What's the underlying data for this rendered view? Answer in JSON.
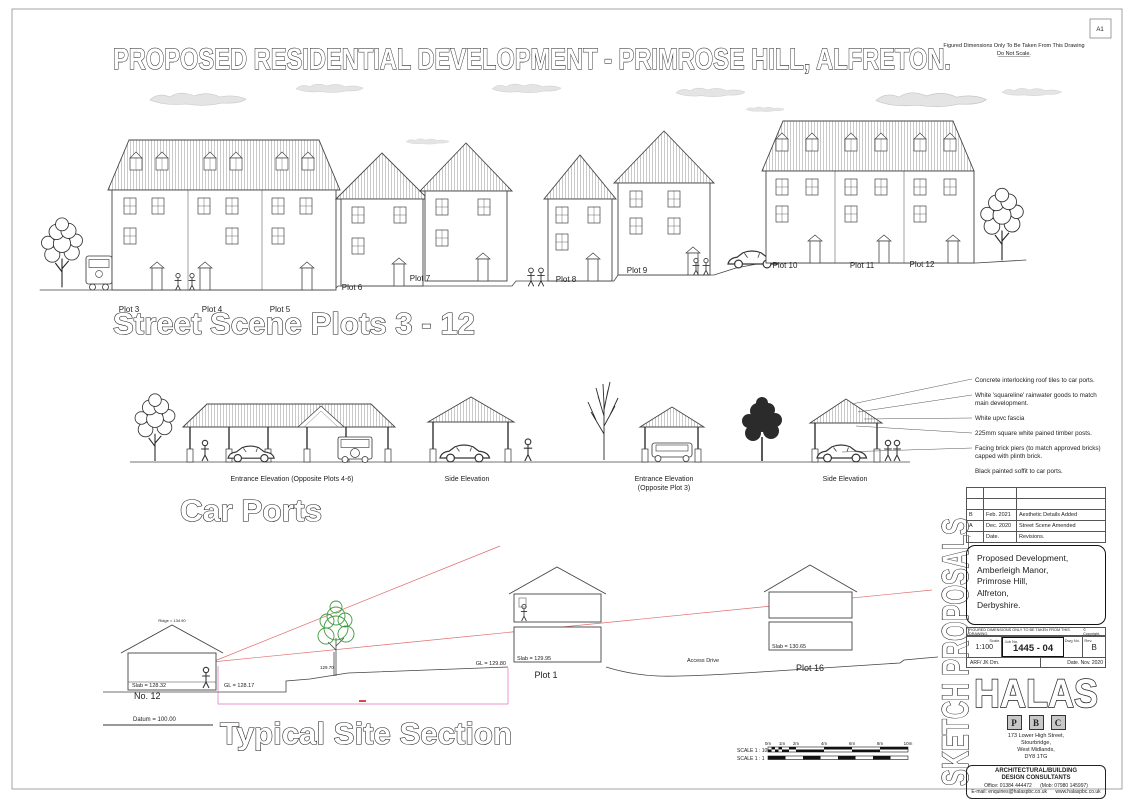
{
  "sheet": {
    "title": "PROPOSED RESIDENTIAL DEVELOPMENT - PRIMROSE HILL, ALFRETON.",
    "paper_size": "A1",
    "top_note_line1": "Figured Dimensions Only To Be Taken From This Drawing",
    "top_note_line2": "Do Not Scale."
  },
  "street_scene": {
    "heading": "Street Scene Plots 3 - 12",
    "plots": [
      "Plot 3",
      "Plot 4",
      "Plot 5",
      "Plot 6",
      "Plot 7",
      "Plot 8",
      "Plot 9",
      "Plot 10",
      "Plot 11",
      "Plot 12"
    ]
  },
  "car_ports": {
    "heading": "Car Ports",
    "elevation_labels": [
      "Entrance Elevation (Opposite Plots 4-6)",
      "Side Elevation",
      "Entrance Elevation",
      "(Opposite Plot 3)",
      "Side Elevation"
    ],
    "notes": [
      "Concrete interlocking roof tiles to car ports.",
      "White 'squareline' rainwater goods to match",
      "main development.",
      "White upvc fascia",
      "225mm square white pained timber posts.",
      "Facing brick piers (to match approved bricks)",
      "capped with plinth brick.",
      "Black  painted soffit to car ports."
    ]
  },
  "site_section": {
    "heading": "Typical Site Section",
    "ridge_label": "Ridge = 134.90",
    "slab_no12": "Slab = 128.32",
    "house_no12": "No. 12",
    "gl_no12": "GL = 128.17",
    "datum": "Datum = 100.00",
    "tree_level": "129.70",
    "gl_plot1": "GL = 129.80",
    "slab_plot1": "Slab = 129.95",
    "plot1": "Plot 1",
    "access_drive": "Access Drive",
    "slab_plot16": "Slab = 130.65",
    "plot16": "Plot 16"
  },
  "scale_bar": {
    "label_100": "SCALE 1 : 100",
    "label_1": "SCALE 1 : 1",
    "ticks": [
      "0m",
      "1m",
      "2m",
      "4m",
      "6m",
      "8m",
      "10m"
    ]
  },
  "title_block": {
    "side_text": "SKETCH PROPOSALS",
    "revisions": [
      {
        "rev": "",
        "date": "",
        "desc": ""
      },
      {
        "rev": "",
        "date": "",
        "desc": ""
      },
      {
        "rev": "B",
        "date": "Feb. 2021",
        "desc": "Aesthetic Details Added"
      },
      {
        "rev": "A",
        "date": "Dec. 2020",
        "desc": "Street Scene Amended"
      },
      {
        "rev": "-",
        "date": "Date.",
        "desc": "Revisions."
      }
    ],
    "project_line1": "Proposed Development,",
    "project_line2": "Amberleigh Manor,",
    "project_line3": "Primrose Hill,",
    "project_line4": "Alfreton,",
    "project_line5": "Derbyshire.",
    "strip_text": "FIGURED DIMENSIONS ONLY TO BE TAKEN FROM THIS DRAWING.",
    "copyright": "© Copyright.",
    "scale_label": "Scale.",
    "scale_value": "1:100",
    "drawn_by": "ARF/ JK Drn.",
    "job_label": "Job No.",
    "drawing_number": "1445 - 04",
    "dwg_label": "Dwg No.",
    "rev_label": "Rev.",
    "rev_value": "B",
    "date_value": "Date. Nov. 2020",
    "logo_text": "HALAS",
    "logo_letter1": "P",
    "logo_letter2": "B",
    "logo_letter3": "C",
    "address_line1": "173 Lower High Street,",
    "address_line2": "Stourbridge,",
    "address_line3": "West Midlands,",
    "address_line4": "DY8 1TG",
    "firm_line1": "ARCHITECTURAL/BUILDING",
    "firm_line2": "DESIGN CONSULTANTS",
    "contact_line1": "Office: 01384 444472      (Mob: 07980 145997)",
    "contact_line2": "E-mail: enquiries@halaspbc.co.uk      www.halaspbc.co.uk"
  }
}
